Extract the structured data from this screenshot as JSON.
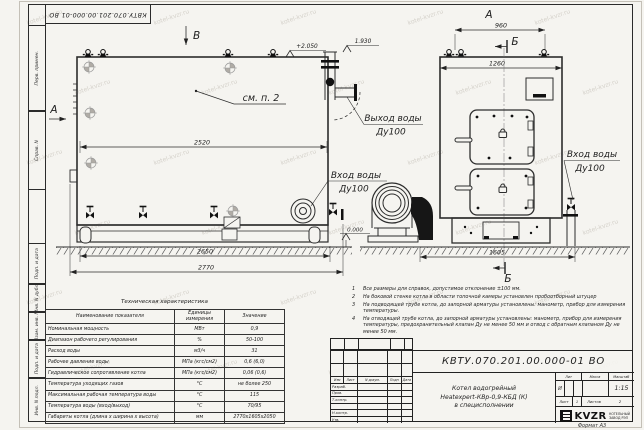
{
  "sheet": {
    "stamp_top": "КВТУ.070.201.00.000-01 ВО",
    "format_label": "Формат  А3",
    "watermark": "kotel-kvzr.ru",
    "margin_labels": {
      "perv": "Перв. примен.",
      "sprav": "Справ. N",
      "podp1": "Подп. и дата",
      "inv_dubl": "Инв. N дубл.",
      "vzam": "Взам. инв. N",
      "podp2": "Подп. и дата",
      "inv_podl": "Инв. N подл."
    }
  },
  "views": {
    "label_v": "В",
    "label_a_side": "А",
    "label_a_top": "А",
    "label_b_top": "Б",
    "label_b_bottom": "Б",
    "see_note": "см. п. 2",
    "elev_top": "+2.050",
    "elev_outlet": "1.930",
    "elev_ground": "0.000",
    "dim_2520": "2520",
    "dim_2650": "2650",
    "dim_2770": "2770",
    "dim_960": "960",
    "dim_1260": "1260",
    "dim_1605": "1605",
    "outlet_label_1": "Выход воды",
    "outlet_label_2": "Ду100",
    "inlet_mid_1": "Вход воды",
    "inlet_mid_2": "Ду100",
    "inlet_right_1": "Вход воды",
    "inlet_right_2": "Ду100"
  },
  "notes": {
    "items": [
      {
        "num": "1",
        "text": "Все размеры для справок, допустимое отклонение ±100 мм."
      },
      {
        "num": "2",
        "text": "На боковой стенке котла в области топочной камеры установлен пробоотборный штуцер"
      },
      {
        "num": "3",
        "text": "На подводящей трубе котла, до запорной арматуры установлены: манометр, прибор для измерения температуры."
      },
      {
        "num": "4",
        "text": "На отводящей трубе котла, до запорной арматуры установлены: манометр, прибор для измерения температуры, предохранительный клапан Ду не менее 50 мм и отвод с обратным клапаном Ду не менее 50 мм."
      }
    ]
  },
  "spec_table": {
    "title": "Техническая характеристика",
    "col_name": "Наименование показателя",
    "col_unit": "Единицы измерения",
    "col_value": "Значение",
    "rows": [
      {
        "name": "Номинальная мощность",
        "unit": "МВт",
        "value": "0,9"
      },
      {
        "name": "Диапазон рабочего регулирования",
        "unit": "%",
        "value": "50-100"
      },
      {
        "name": "Расход воды",
        "unit": "м3/ч",
        "value": "31"
      },
      {
        "name": "Рабочее давление воды",
        "unit": "МПа (кгс/см2)",
        "value": "0,6 (6,0)"
      },
      {
        "name": "Гидравлическое сопротивление котла",
        "unit": "МПа (кгс/см2)",
        "value": "0,06 (0,6)"
      },
      {
        "name": "Температура уходящих газов",
        "unit": "°С",
        "value": "не более 250"
      },
      {
        "name": "Максимальная рабочая температура воды",
        "unit": "°С",
        "value": "115"
      },
      {
        "name": "Температура воды (вход/выход)",
        "unit": "°С",
        "value": "70/95"
      },
      {
        "name": "Габариты котла (длина х ширина х высота)",
        "unit": "мм",
        "value": "2770х1605х2050"
      }
    ]
  },
  "title_block": {
    "doc_number": "КВТУ.070.201.00.000-01 ВО",
    "product_line1": "Котел водогрейный",
    "product_line2": "Heatexpert-КВр-0,9-КБД (К)",
    "product_line3": "в специсполнении",
    "rev_cols": {
      "izm": "Изм",
      "list": "Лист",
      "ndoc": "N докум.",
      "podp": "Подп",
      "data": "Дата"
    },
    "rows": {
      "razrab": "Разраб.",
      "prov": "Пров.",
      "tkontr": "Т.контр.",
      "nkontr": "Н.контр.",
      "utv": "Утв."
    },
    "lit_label": "Лит",
    "mass_label": "Масса",
    "scale_label": "Масштаб",
    "lit_value": "И",
    "scale_value": "1:15",
    "sheet_label": "Лист",
    "sheet_value": "1",
    "sheets_label": "Листов",
    "sheets_value": "2",
    "logo_text": "KVZR",
    "logo_caption1": "КОТЕЛЬНЫЙ",
    "logo_caption2": "ЗАВОД РЭП"
  }
}
